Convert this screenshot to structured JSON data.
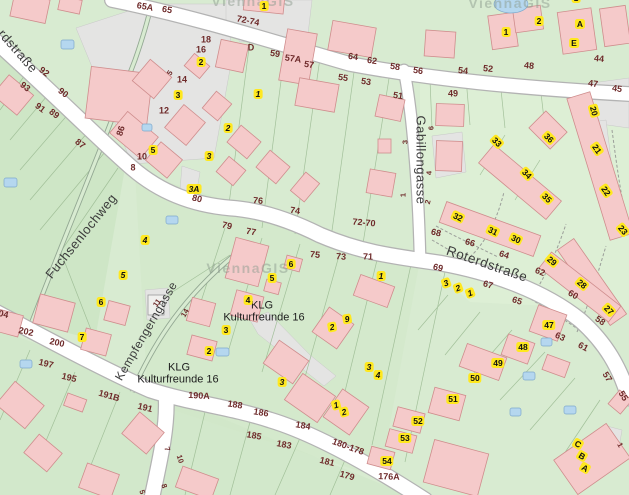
{
  "map": {
    "app": "ViennaGIS city map extract",
    "watermark_text": "ViennaGIS",
    "colors": {
      "green": "#d8ebd1",
      "green_dark": "#cee6c6",
      "green_mid": "#d4e9cc",
      "green_light": "#ddefd5",
      "grey": "#e4e4e3",
      "road": "#ffffff",
      "road_casing": "#b3b3b3",
      "building": "#f5caca",
      "building_outline": "#cf8d8d",
      "pool": "#b5d7ef",
      "yellow": "#ffe81f",
      "addr": "#6e2a2a",
      "street_text": "#3c3c3c"
    },
    "street_names": [
      "rdstraße",
      "Fuchsenlochweg",
      "Gabillongasse",
      "Roterdstraße",
      "Kempfengerngasse"
    ],
    "labels": [
      {
        "t": "rdstraße",
        "x": 18,
        "y": 51,
        "r": 49,
        "s": "street"
      },
      {
        "t": "Fuchsenlochweg",
        "x": 81,
        "y": 236,
        "r": -51,
        "s": "street"
      },
      {
        "t": "Gabillongasse",
        "x": 421,
        "y": 160,
        "r": 90,
        "s": "street"
      },
      {
        "t": "Roterdstraße",
        "x": 487,
        "y": 264,
        "r": 19,
        "s": "street",
        "sz": 13.5
      },
      {
        "t": "Kempfengerngasse",
        "x": 146,
        "y": 331,
        "r": -60,
        "s": "street",
        "sz": 12
      },
      {
        "t": "KLG",
        "x": 262,
        "y": 306,
        "r": 0,
        "s": "klg"
      },
      {
        "t": "Kulturfreunde 16",
        "x": 264,
        "y": 318,
        "r": 0,
        "s": "klg"
      },
      {
        "t": "KLG",
        "x": 179,
        "y": 368,
        "r": 0,
        "s": "klg"
      },
      {
        "t": "Kulturfreunde 16",
        "x": 178,
        "y": 380,
        "r": 0,
        "s": "klg"
      },
      {
        "t": "ViennaGIS",
        "x": 248,
        "y": 268,
        "r": 0,
        "s": "wm"
      },
      {
        "t": "ViennaGIS",
        "x": 510,
        "y": 3,
        "r": 0,
        "s": "wm"
      },
      {
        "t": "ViennaGIS",
        "x": 253,
        "y": 1,
        "r": 0,
        "s": "wm"
      },
      {
        "t": "65A",
        "x": 145,
        "y": 7,
        "r": 10,
        "s": "addr"
      },
      {
        "t": "65",
        "x": 167,
        "y": 10,
        "r": 10,
        "s": "addr"
      },
      {
        "t": "92",
        "x": 44,
        "y": 72,
        "r": 38,
        "s": "addr"
      },
      {
        "t": "90",
        "x": 63,
        "y": 93,
        "r": 38,
        "s": "addr"
      },
      {
        "t": "93",
        "x": 25,
        "y": 87,
        "r": 38,
        "s": "addr"
      },
      {
        "t": "91",
        "x": 40,
        "y": 108,
        "r": 38,
        "s": "addr"
      },
      {
        "t": "89",
        "x": 54,
        "y": 114,
        "r": 38,
        "s": "addr"
      },
      {
        "t": "87",
        "x": 80,
        "y": 144,
        "r": 38,
        "s": "addr"
      },
      {
        "t": "86",
        "x": 121,
        "y": 131,
        "r": -72,
        "s": "addr"
      },
      {
        "t": "72-74",
        "x": 248,
        "y": 21,
        "r": 11,
        "s": "addr"
      },
      {
        "t": "D",
        "x": 251,
        "y": 48,
        "r": 0,
        "s": "addr"
      },
      {
        "t": "59",
        "x": 275,
        "y": 54,
        "r": 8,
        "s": "addr"
      },
      {
        "t": "57A",
        "x": 293,
        "y": 59,
        "r": 8,
        "s": "addr"
      },
      {
        "t": "57",
        "x": 309,
        "y": 65,
        "r": 8,
        "s": "addr"
      },
      {
        "t": "64",
        "x": 353,
        "y": 57,
        "r": 8,
        "s": "addr"
      },
      {
        "t": "62",
        "x": 372,
        "y": 61,
        "r": 8,
        "s": "addr"
      },
      {
        "t": "58",
        "x": 395,
        "y": 67,
        "r": 8,
        "s": "addr"
      },
      {
        "t": "56",
        "x": 418,
        "y": 71,
        "r": 8,
        "s": "addr"
      },
      {
        "t": "54",
        "x": 463,
        "y": 71,
        "r": 6,
        "s": "addr"
      },
      {
        "t": "52",
        "x": 488,
        "y": 69,
        "r": 6,
        "s": "addr"
      },
      {
        "t": "48",
        "x": 529,
        "y": 66,
        "r": 6,
        "s": "addr"
      },
      {
        "t": "44",
        "x": 599,
        "y": 59,
        "r": 6,
        "s": "addr"
      },
      {
        "t": "55",
        "x": 343,
        "y": 78,
        "r": 8,
        "s": "addr"
      },
      {
        "t": "53",
        "x": 366,
        "y": 82,
        "r": 8,
        "s": "addr"
      },
      {
        "t": "51",
        "x": 398,
        "y": 96,
        "r": 8,
        "s": "addr"
      },
      {
        "t": "49",
        "x": 453,
        "y": 94,
        "r": 0,
        "s": "addr"
      },
      {
        "t": "47",
        "x": 593,
        "y": 84,
        "r": 8,
        "s": "addr"
      },
      {
        "t": "45",
        "x": 617,
        "y": 89,
        "r": 8,
        "s": "addr"
      },
      {
        "t": "18",
        "x": 206,
        "y": 40,
        "r": 0,
        "s": "addr"
      },
      {
        "t": "16",
        "x": 201,
        "y": 50,
        "r": 0,
        "s": "addr"
      },
      {
        "t": "14",
        "x": 182,
        "y": 80,
        "r": 0,
        "s": "addr"
      },
      {
        "t": "12",
        "x": 164,
        "y": 111,
        "r": 0,
        "s": "addr"
      },
      {
        "t": "10",
        "x": 142,
        "y": 157,
        "r": 0,
        "s": "addr"
      },
      {
        "t": "8",
        "x": 133,
        "y": 168,
        "r": 0,
        "s": "addr"
      },
      {
        "t": "5",
        "x": 170,
        "y": 73,
        "r": -55,
        "s": "addr-sm"
      },
      {
        "t": "6",
        "x": 431,
        "y": 128,
        "r": -90,
        "s": "addr-sm"
      },
      {
        "t": "4",
        "x": 429,
        "y": 173,
        "r": -90,
        "s": "addr-sm"
      },
      {
        "t": "2",
        "x": 428,
        "y": 202,
        "r": -75,
        "s": "addr-sm"
      },
      {
        "t": "3",
        "x": 405,
        "y": 142,
        "r": -90,
        "s": "addr-sm"
      },
      {
        "t": "1",
        "x": 403,
        "y": 195,
        "r": -90,
        "s": "addr-sm"
      },
      {
        "t": "80",
        "x": 197,
        "y": 199,
        "r": 14,
        "s": "addr"
      },
      {
        "t": "79",
        "x": 227,
        "y": 226,
        "r": 14,
        "s": "addr"
      },
      {
        "t": "77",
        "x": 251,
        "y": 232,
        "r": 10,
        "s": "addr"
      },
      {
        "t": "76",
        "x": 258,
        "y": 201,
        "r": 6,
        "s": "addr"
      },
      {
        "t": "74",
        "x": 295,
        "y": 211,
        "r": 8,
        "s": "addr"
      },
      {
        "t": "72-70",
        "x": 364,
        "y": 223,
        "r": 5,
        "s": "addr"
      },
      {
        "t": "75",
        "x": 315,
        "y": 255,
        "r": 6,
        "s": "addr"
      },
      {
        "t": "73",
        "x": 341,
        "y": 257,
        "r": 4,
        "s": "addr"
      },
      {
        "t": "71",
        "x": 368,
        "y": 257,
        "r": 2,
        "s": "addr"
      },
      {
        "t": "68",
        "x": 436,
        "y": 233,
        "r": 14,
        "s": "addr"
      },
      {
        "t": "66",
        "x": 470,
        "y": 243,
        "r": 16,
        "s": "addr"
      },
      {
        "t": "64",
        "x": 504,
        "y": 255,
        "r": 18,
        "s": "addr"
      },
      {
        "t": "62",
        "x": 540,
        "y": 272,
        "r": 22,
        "s": "addr"
      },
      {
        "t": "60",
        "x": 573,
        "y": 295,
        "r": 30,
        "s": "addr"
      },
      {
        "t": "58",
        "x": 600,
        "y": 321,
        "r": 35,
        "s": "addr"
      },
      {
        "t": "69",
        "x": 438,
        "y": 268,
        "r": 14,
        "s": "addr"
      },
      {
        "t": "67",
        "x": 488,
        "y": 285,
        "r": 16,
        "s": "addr"
      },
      {
        "t": "65",
        "x": 517,
        "y": 301,
        "r": 18,
        "s": "addr"
      },
      {
        "t": "63",
        "x": 560,
        "y": 337,
        "r": 25,
        "s": "addr"
      },
      {
        "t": "61",
        "x": 583,
        "y": 347,
        "r": 28,
        "s": "addr"
      },
      {
        "t": "57",
        "x": 607,
        "y": 377,
        "r": 58,
        "s": "addr"
      },
      {
        "t": "55",
        "x": 623,
        "y": 396,
        "r": 58,
        "s": "addr"
      },
      {
        "t": "204",
        "x": 1,
        "y": 314,
        "r": 12,
        "s": "addr"
      },
      {
        "t": "202",
        "x": 26,
        "y": 332,
        "r": 12,
        "s": "addr"
      },
      {
        "t": "200",
        "x": 57,
        "y": 343,
        "r": 12,
        "s": "addr"
      },
      {
        "t": "197",
        "x": 46,
        "y": 364,
        "r": 14,
        "s": "addr"
      },
      {
        "t": "195",
        "x": 69,
        "y": 378,
        "r": 14,
        "s": "addr"
      },
      {
        "t": "191B",
        "x": 109,
        "y": 396,
        "r": 16,
        "s": "addr"
      },
      {
        "t": "191",
        "x": 145,
        "y": 408,
        "r": 14,
        "s": "addr"
      },
      {
        "t": "190A",
        "x": 199,
        "y": 396,
        "r": 3,
        "s": "addr"
      },
      {
        "t": "188",
        "x": 235,
        "y": 405,
        "r": 8,
        "s": "addr"
      },
      {
        "t": "186",
        "x": 261,
        "y": 413,
        "r": 9,
        "s": "addr"
      },
      {
        "t": "184",
        "x": 303,
        "y": 426,
        "r": 10,
        "s": "addr"
      },
      {
        "t": "185",
        "x": 254,
        "y": 436,
        "r": 10,
        "s": "addr"
      },
      {
        "t": "183",
        "x": 284,
        "y": 445,
        "r": 11,
        "s": "addr"
      },
      {
        "t": "181",
        "x": 327,
        "y": 462,
        "r": 14,
        "s": "addr"
      },
      {
        "t": "179",
        "x": 347,
        "y": 476,
        "r": 16,
        "s": "addr"
      },
      {
        "t": "180-178",
        "x": 348,
        "y": 447,
        "r": 20,
        "s": "addr"
      },
      {
        "t": "176A",
        "x": 389,
        "y": 477,
        "r": 2,
        "s": "addr"
      },
      {
        "t": "7",
        "x": 167,
        "y": 449,
        "r": 72,
        "s": "addr-sm"
      },
      {
        "t": "10",
        "x": 180,
        "y": 459,
        "r": 72,
        "s": "addr-sm"
      },
      {
        "t": "8",
        "x": 164,
        "y": 486,
        "r": 72,
        "s": "addr-sm"
      },
      {
        "t": "5",
        "x": 142,
        "y": 492,
        "r": 72,
        "s": "addr-sm"
      },
      {
        "t": "1",
        "x": 620,
        "y": 445,
        "r": 60,
        "s": "addr-sm"
      },
      {
        "t": "11",
        "x": 157,
        "y": 303,
        "r": -55,
        "s": "addr-sm"
      },
      {
        "t": "14",
        "x": 185,
        "y": 313,
        "r": -60,
        "s": "addr-sm"
      },
      {
        "t": "2",
        "x": 201,
        "y": 62,
        "r": 0,
        "s": "yellow"
      },
      {
        "t": "3",
        "x": 178,
        "y": 95,
        "r": 0,
        "s": "yellow"
      },
      {
        "t": "5",
        "x": 153,
        "y": 150,
        "r": 0,
        "s": "yellow"
      },
      {
        "t": "1",
        "x": 264,
        "y": 6,
        "r": 0,
        "s": "yellow"
      },
      {
        "t": "1",
        "x": 506,
        "y": 32,
        "r": 0,
        "s": "yellow"
      },
      {
        "t": "2",
        "x": 539,
        "y": 21,
        "r": 0,
        "s": "yellow"
      },
      {
        "t": "A",
        "x": 580,
        "y": 24,
        "r": 0,
        "s": "yellow"
      },
      {
        "t": "E",
        "x": 574,
        "y": 43,
        "r": 0,
        "s": "yellow"
      },
      {
        "t": "1",
        "x": 576,
        "y": -2,
        "r": 0,
        "s": "yellow"
      },
      {
        "t": "47",
        "x": 549,
        "y": 325,
        "r": 0,
        "s": "yellow"
      },
      {
        "t": "48",
        "x": 523,
        "y": 347,
        "r": 0,
        "s": "yellow"
      },
      {
        "t": "49",
        "x": 498,
        "y": 363,
        "r": 0,
        "s": "yellow"
      },
      {
        "t": "50",
        "x": 475,
        "y": 378,
        "r": 0,
        "s": "yellow"
      },
      {
        "t": "51",
        "x": 453,
        "y": 399,
        "r": 0,
        "s": "yellow"
      },
      {
        "t": "52",
        "x": 418,
        "y": 421,
        "r": 0,
        "s": "yellow"
      },
      {
        "t": "53",
        "x": 405,
        "y": 438,
        "r": 0,
        "s": "yellow"
      },
      {
        "t": "54",
        "x": 387,
        "y": 461,
        "r": 0,
        "s": "yellow"
      },
      {
        "t": "6",
        "x": 291,
        "y": 264,
        "r": 0,
        "s": "yellow"
      },
      {
        "t": "5",
        "x": 272,
        "y": 278,
        "r": 0,
        "s": "yellow"
      },
      {
        "t": "4",
        "x": 248,
        "y": 300,
        "r": 0,
        "s": "yellow"
      },
      {
        "t": "3",
        "x": 226,
        "y": 330,
        "r": 0,
        "s": "yellow"
      },
      {
        "t": "2",
        "x": 209,
        "y": 351,
        "r": 0,
        "s": "yellow"
      },
      {
        "t": "6",
        "x": 101,
        "y": 302,
        "r": 0,
        "s": "yellow"
      },
      {
        "t": "7",
        "x": 82,
        "y": 337,
        "r": 0,
        "s": "yellow"
      },
      {
        "t": "20",
        "x": 594,
        "y": 111,
        "r": 75,
        "s": "yellow"
      },
      {
        "t": "21",
        "x": 597,
        "y": 149,
        "r": 55,
        "s": "yellow"
      },
      {
        "t": "22",
        "x": 606,
        "y": 191,
        "r": 55,
        "s": "yellow"
      },
      {
        "t": "23",
        "x": 623,
        "y": 230,
        "r": 50,
        "s": "yellow"
      },
      {
        "t": "36",
        "x": 549,
        "y": 138,
        "r": 45,
        "s": "yellow"
      },
      {
        "t": "33",
        "x": 497,
        "y": 142,
        "r": 45,
        "s": "yellow"
      },
      {
        "t": "34",
        "x": 527,
        "y": 174,
        "r": 45,
        "s": "yellow"
      },
      {
        "t": "35",
        "x": 547,
        "y": 198,
        "r": 45,
        "s": "yellow"
      },
      {
        "t": "32",
        "x": 458,
        "y": 217,
        "r": 25,
        "s": "yellow"
      },
      {
        "t": "31",
        "x": 493,
        "y": 231,
        "r": 25,
        "s": "yellow"
      },
      {
        "t": "30",
        "x": 516,
        "y": 239,
        "r": 25,
        "s": "yellow"
      },
      {
        "t": "29",
        "x": 552,
        "y": 261,
        "r": 40,
        "s": "yellow"
      },
      {
        "t": "28",
        "x": 582,
        "y": 284,
        "r": 40,
        "s": "yellow"
      },
      {
        "t": "27",
        "x": 609,
        "y": 310,
        "r": 45,
        "s": "yellow"
      },
      {
        "t": "C",
        "x": 578,
        "y": 444,
        "r": 30,
        "s": "yellow"
      },
      {
        "t": "B",
        "x": 582,
        "y": 456,
        "r": 30,
        "s": "yellow"
      },
      {
        "t": "A",
        "x": 585,
        "y": 468,
        "r": 30,
        "s": "yellow"
      },
      {
        "t": "1",
        "x": 258,
        "y": 94,
        "r": 0,
        "s": "yellow-i"
      },
      {
        "t": "2",
        "x": 228,
        "y": 128,
        "r": 0,
        "s": "yellow-i"
      },
      {
        "t": "3",
        "x": 209,
        "y": 156,
        "r": 0,
        "s": "yellow-i"
      },
      {
        "t": "3A",
        "x": 194,
        "y": 189,
        "r": 0,
        "s": "yellow-i"
      },
      {
        "t": "4",
        "x": 145,
        "y": 240,
        "r": 0,
        "s": "yellow-i"
      },
      {
        "t": "5",
        "x": 123,
        "y": 275,
        "r": 0,
        "s": "yellow-i"
      },
      {
        "t": "1",
        "x": 381,
        "y": 276,
        "r": 0,
        "s": "yellow-i"
      },
      {
        "t": "9",
        "x": 347,
        "y": 319,
        "r": -10,
        "s": "yellow-i"
      },
      {
        "t": "2",
        "x": 332,
        "y": 327,
        "r": -10,
        "s": "yellow-i"
      },
      {
        "t": "3",
        "x": 282,
        "y": 382,
        "r": 0,
        "s": "yellow-i"
      },
      {
        "t": "3",
        "x": 369,
        "y": 367,
        "r": 0,
        "s": "yellow-i"
      },
      {
        "t": "4",
        "x": 378,
        "y": 375,
        "r": 0,
        "s": "yellow-i"
      },
      {
        "t": "1",
        "x": 336,
        "y": 405,
        "r": -15,
        "s": "yellow-i"
      },
      {
        "t": "2",
        "x": 344,
        "y": 412,
        "r": -15,
        "s": "yellow-i"
      },
      {
        "t": "3",
        "x": 446,
        "y": 283,
        "r": -20,
        "s": "yellow-i"
      },
      {
        "t": "2",
        "x": 458,
        "y": 288,
        "r": -20,
        "s": "yellow-i"
      },
      {
        "t": "1",
        "x": 470,
        "y": 293,
        "r": -20,
        "s": "yellow-i"
      }
    ]
  }
}
